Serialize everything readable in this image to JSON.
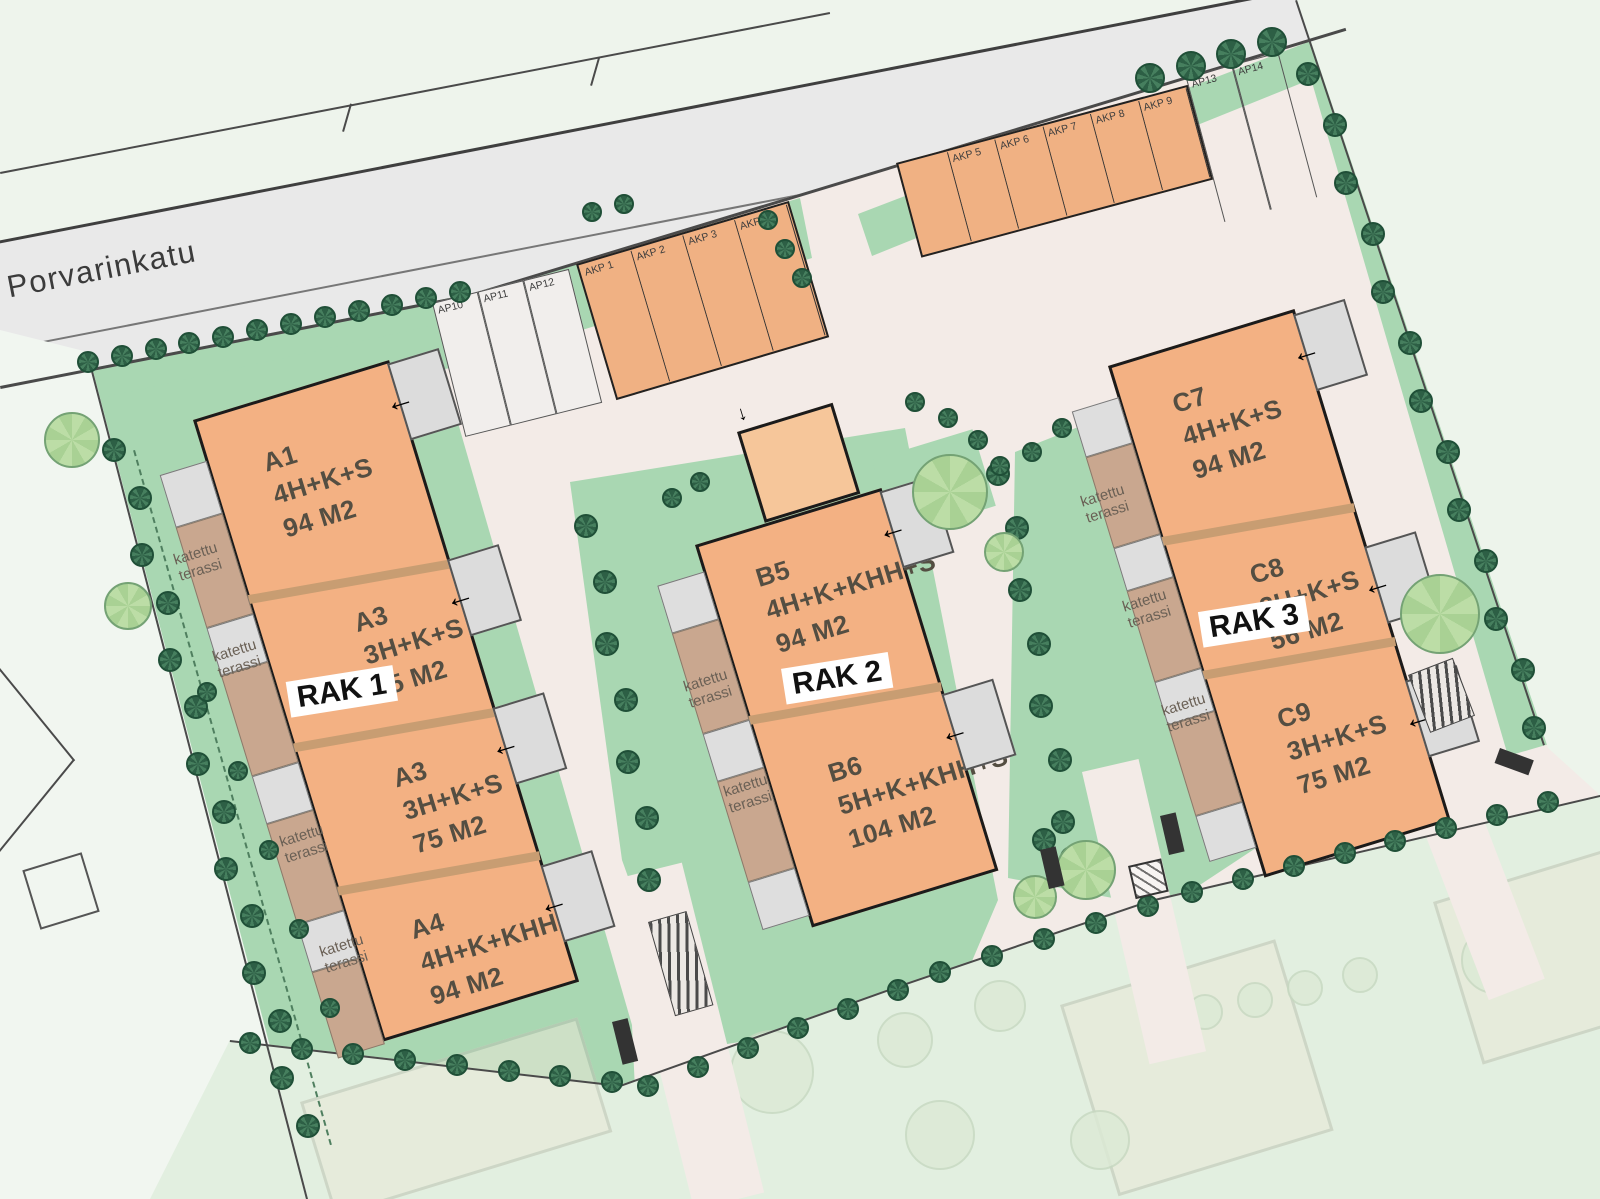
{
  "street": {
    "name": "Porvarinkatu"
  },
  "labels": {
    "covered_terrace": "katettu terassi"
  },
  "buildings": [
    {
      "id": "rak1",
      "label": "RAK 1",
      "units": [
        {
          "name": "A1",
          "type": "4H+K+S",
          "area": "94 M2"
        },
        {
          "name": "A3",
          "type": "3H+K+S",
          "area": "75 M2"
        },
        {
          "name": "A3",
          "type": "3H+K+S",
          "area": "75 M2"
        },
        {
          "name": "A4",
          "type": "4H+K+KHH+S",
          "area": "94 M2"
        }
      ]
    },
    {
      "id": "rak2",
      "label": "RAK 2",
      "units": [
        {
          "name": "B5",
          "type": "4H+K+KHH+S",
          "area": "94 M2"
        },
        {
          "name": "B6",
          "type": "5H+K+KHH+S",
          "area": "104 M2"
        }
      ]
    },
    {
      "id": "rak3",
      "label": "RAK 3",
      "units": [
        {
          "name": "C7",
          "type": "4H+K+S",
          "area": "94 M2"
        },
        {
          "name": "C8",
          "type": "2H+K+S",
          "area": "56 M2"
        },
        {
          "name": "C9",
          "type": "3H+K+S",
          "area": "75 M2"
        }
      ]
    }
  ],
  "parking": {
    "row1_white": [
      "AP10",
      "AP11",
      "AP12"
    ],
    "row1_covered": [
      "AKP 1",
      "AKP 2",
      "AKP 3",
      "AKP 4"
    ],
    "row2_covered": [
      "",
      "AKP 5",
      "AKP 6",
      "AKP 7",
      "AKP 8",
      "AKP 9"
    ],
    "row2_white": [
      "AP13",
      "AP14"
    ]
  },
  "colors": {
    "building": "#f3b183",
    "building_annex": "#f6c69a",
    "building_outline": "#1b1b1b",
    "covered_terrace": "#c9a78f",
    "porch": "#dcdcdc",
    "garden": "#a9d7b2",
    "driveway": "#f3ebe7",
    "road": "#e9e9e9",
    "tree_dark": "#2d5f45",
    "tree_light": "#b9dba4",
    "unit_divider": "#c89d72",
    "neighbor_faded": "#e2efe0"
  }
}
